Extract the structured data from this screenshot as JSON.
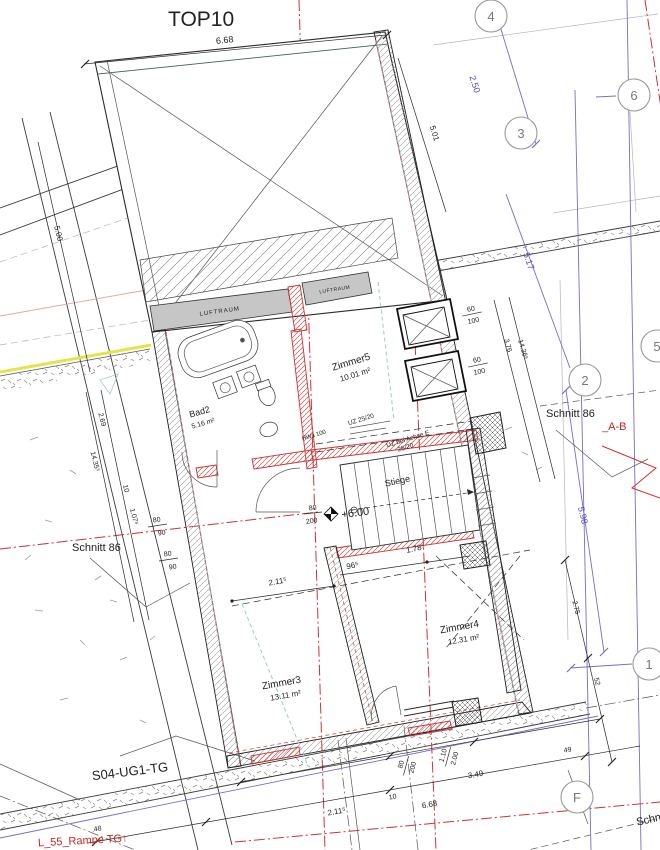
{
  "title": "TOP10",
  "colors": {
    "red": "#cc2222",
    "purple": "#6a5acd",
    "teal": "#93cfcf",
    "yellow": "#e8e000",
    "wall_gray": "#c6c6c6"
  },
  "axes": {
    "a1": "1",
    "a2": "2",
    "a3": "3",
    "a4": "4",
    "a5": "5",
    "a6": "6",
    "aF": "F"
  },
  "rooms": {
    "zimmer5": {
      "name": "Zimmer5",
      "area": "10.01 m²"
    },
    "bad2": {
      "name": "Bad2",
      "area": "5.16 m²"
    },
    "zimmer3": {
      "name": "Zimmer3",
      "area": "13.11 m²"
    },
    "zimmer4": {
      "name": "Zimmer4",
      "area": "12.31 m²"
    },
    "stiege": {
      "name": "Stiege"
    }
  },
  "labels": {
    "luftraum_left": "LUFTRAUM",
    "luftraum_right": "LUFTRAUM",
    "level": "+6.00",
    "uz_left": "UZ 25/20",
    "uz_right_line1": "UZ bei Achse E",
    "uz_right_line2": "25/20",
    "hwa": "HWa 100",
    "schnitt_left": "Schnitt 86",
    "schnitt_right": "Schnitt 86",
    "schnitt_bottom": "Schnitt 86",
    "section_ab": "_A-B",
    "s04": "S04-UG1-TG",
    "rampe": "L_55_Rampe TG↑"
  },
  "dims": {
    "top_width": "6.68",
    "axis_34": "2.50",
    "wall_right_top": "5.01",
    "slope_right": "5.17",
    "left_upper": "5.00",
    "left_269": "2.69",
    "left_total": "14.35⁵",
    "left_10": "10",
    "left_107": "1.07⁵",
    "door_a_w": "80",
    "door_a_h": "90",
    "door_b_w": "80",
    "door_b_h": "90",
    "door_stair_w": "80",
    "door_stair_h": "200",
    "stair_96": "96⁵",
    "z4_178": "1.78⁵",
    "z3_211": "2.11⁵",
    "right_376": "3.76",
    "right_total": "14.36⁵",
    "win_a_w": "60",
    "win_a_h": "100",
    "win_b_w": "60",
    "win_b_h": "100",
    "axis_right": "5.98",
    "right_275": "2.75",
    "right_52": "52",
    "bottom_door_w": "80",
    "bottom_door_h": "200",
    "bottom_win_w": "1.10",
    "bottom_win_h": "2.00",
    "bottom_349": "3.49",
    "bottom_49": "49",
    "bottom_10": "10",
    "bottom_width": "6.68",
    "bottom_211": "2.11⁵",
    "bottom_48": ".48"
  }
}
